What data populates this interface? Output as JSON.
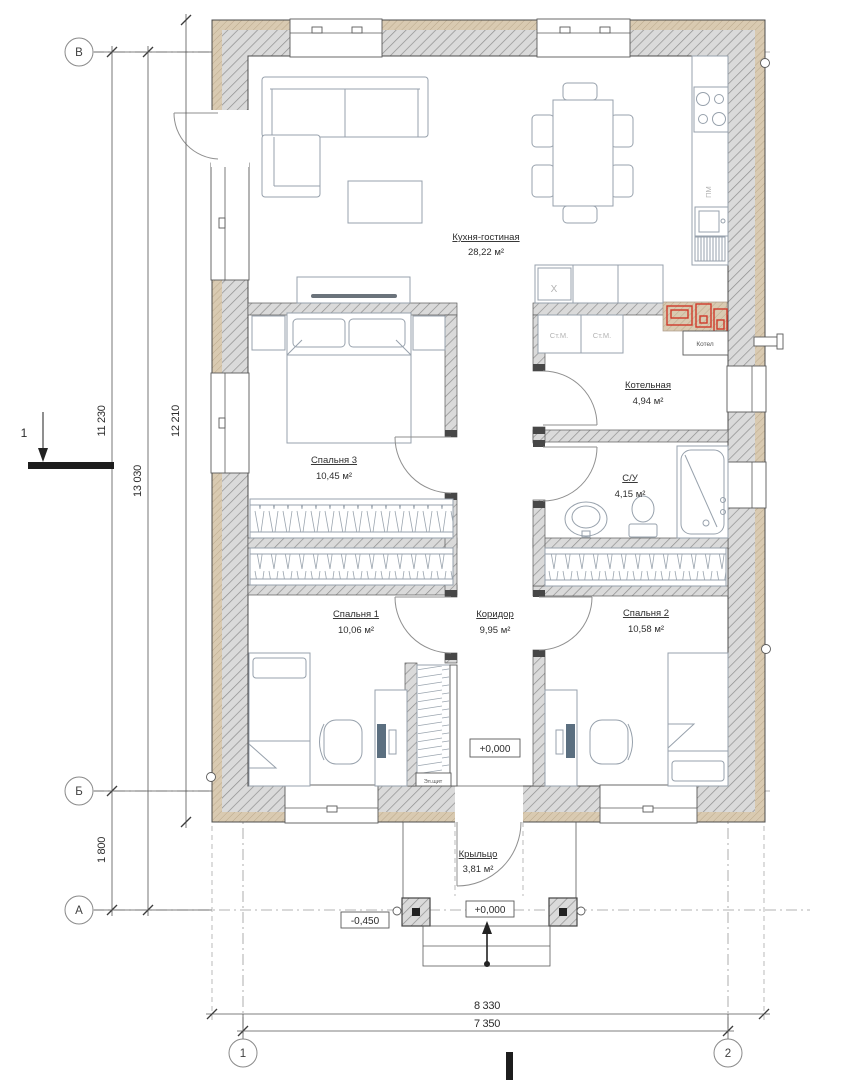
{
  "plan": {
    "rooms": [
      {
        "name": "Кухня-гостиная",
        "area": "28,22 м²"
      },
      {
        "name": "Спальня 3",
        "area": "10,45 м²"
      },
      {
        "name": "Котельная",
        "area": "4,94 м²"
      },
      {
        "name": "С/У",
        "area": "4,15 м²"
      },
      {
        "name": "Спальня 1",
        "area": "10,06 м²"
      },
      {
        "name": "Коридор",
        "area": "9,95 м²"
      },
      {
        "name": "Спальня 2",
        "area": "10,58 м²"
      },
      {
        "name": "Крыльцо",
        "area": "3,81 м²"
      }
    ],
    "equipment": {
      "washer_left": "Ст.М.",
      "washer_right": "Ст.М.",
      "boiler": "Котел",
      "dishwasher": "ПМ",
      "kitchen_unit": "Х",
      "electrical_panel": "Эл.щит"
    },
    "elevations": {
      "corridor": "+0,000",
      "porch": "+0,000",
      "ground": "-0,450"
    },
    "axes": {
      "rows": [
        "В",
        "Б",
        "А"
      ],
      "cols": [
        "1",
        "2"
      ]
    },
    "dimensions": {
      "left": [
        "11 230",
        "13 030",
        "12 210"
      ],
      "row_spacing": "1 800",
      "bottom": [
        "8 330",
        "7 350"
      ]
    },
    "section": {
      "mark": "1"
    },
    "colors": {
      "wall_fill": "#dadada",
      "wall_hatch": "#8f8f8f",
      "insulation": "#d9cab1",
      "accent_red": "#d03a2a",
      "line": "#4a4a4a"
    }
  }
}
